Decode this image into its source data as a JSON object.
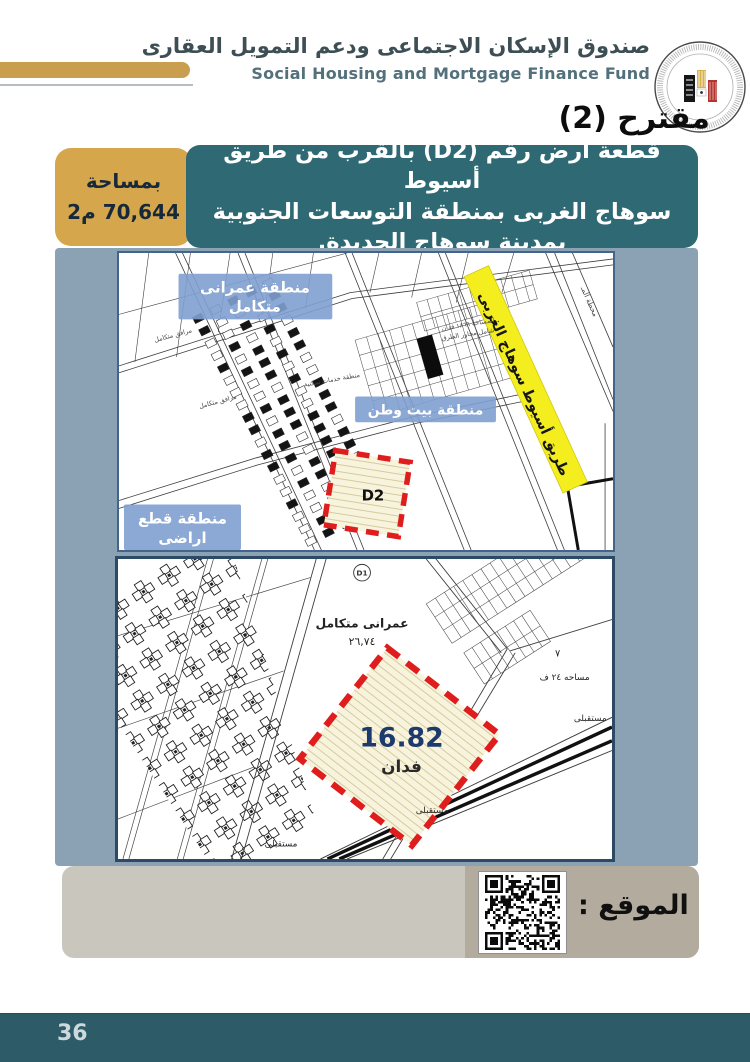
{
  "page": {
    "number": "36"
  },
  "header": {
    "org_name_ar": "صندوق الإسكان الاجتماعى ودعم التمويل العقارى",
    "org_name_en": "Social Housing and Mortgage Finance Fund",
    "logo": "social-housing-fund-seal",
    "proposal_title": "مقترح (2)"
  },
  "title_block": {
    "area_label": "بمساحة",
    "area_value": "70,644 م2",
    "line1": "قطعة أرض رقم (D2) بالقرب من طريق أسيوط",
    "line2": "سوهاج الغربى بمنطقة التوسعات الجنوبية",
    "line3": "بمدينة سوهاج الجديدة."
  },
  "map_top": {
    "label_urban_line1": "منطقة عمرانى",
    "label_urban_line2": "متكامل",
    "label_beit_watan": "منطقة بيت وطن",
    "label_plots_line1": "منطقة قطع",
    "label_plots_line2": "اراضى",
    "road_label": "طريق أسيوط سوهاج الغربى",
    "plot_code": "D2",
    "note_line1": "المساحة ١٨٦٩ فدان",
    "note_line2": "شامل محاور الطرق",
    "small_label_services": "منطقة خدمات سكنية",
    "small_label_utilities": "مرافق متكامل",
    "small_label_station": "محطة المـ"
  },
  "map_bottom": {
    "plot_code": "D1",
    "parcel_label": "عمرانى متكامل",
    "parcel_area": "٢٦,٧٤",
    "area_value": "16.82",
    "area_unit": "فدان",
    "future_label": "مستقبلى",
    "side_area_label": "مساحه ٢٤ ف",
    "side_number": "٧"
  },
  "location_bar": {
    "label": "الموقع :",
    "icon": "qr-code"
  },
  "colors": {
    "gold": "#c99e4e",
    "gold_box": "#d6a64d",
    "teal_box": "#2f6a74",
    "panel": "#8aa2b4",
    "map_label_blue": "#7f9fcf",
    "road_yellow": "#f4ee1e",
    "plot_red": "#df1d1d",
    "value_blue": "#1d3a6e",
    "footer": "#2d5c68"
  }
}
